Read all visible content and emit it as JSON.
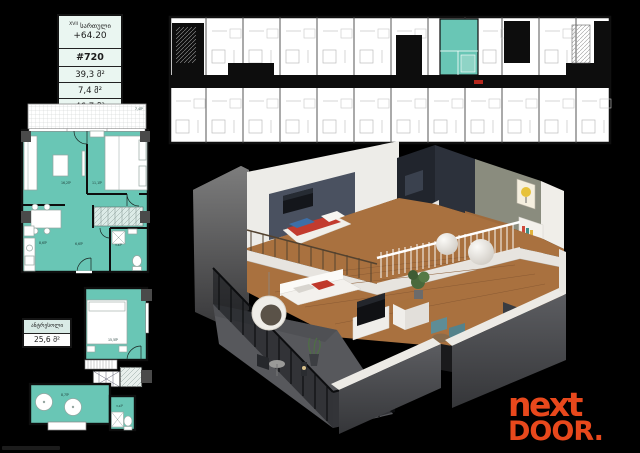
{
  "sheet": {
    "background": "#000000"
  },
  "info_box": {
    "floor_number": "XVII",
    "floor_word": "სართული",
    "elevation": "+64.20",
    "unit_number": "#720",
    "area_interior": "39,3 მ²",
    "area_balcony": "7,4 მ²",
    "area_total": "46,7 მ²"
  },
  "mezzanine_box": {
    "title": "ანტრესოლი",
    "area": "25,6 მ²"
  },
  "main_plan_labels": {
    "balcony": "7,4მ²",
    "living": "16,2მ²",
    "bedroom": "11,1მ²",
    "kitchen": "8,6მ²",
    "hall": "6,6მ²",
    "bathroom": "3,4მ²"
  },
  "mezzanine_plan_labels": {
    "bedroom": "15,5მ²",
    "lounge": "8,7მ²",
    "bathroom": "3,2მ²"
  },
  "logo": {
    "line1": "next",
    "line2": "DOOR."
  },
  "colors": {
    "plan_teal": "#69C6B5",
    "plan_teal_light": "#8FD4C6",
    "logo_red": "#E8481C",
    "accent_wall": "#4A5160",
    "wood_floor": "#A9713F",
    "exterior_wall_gray": "#4A4B4F"
  }
}
